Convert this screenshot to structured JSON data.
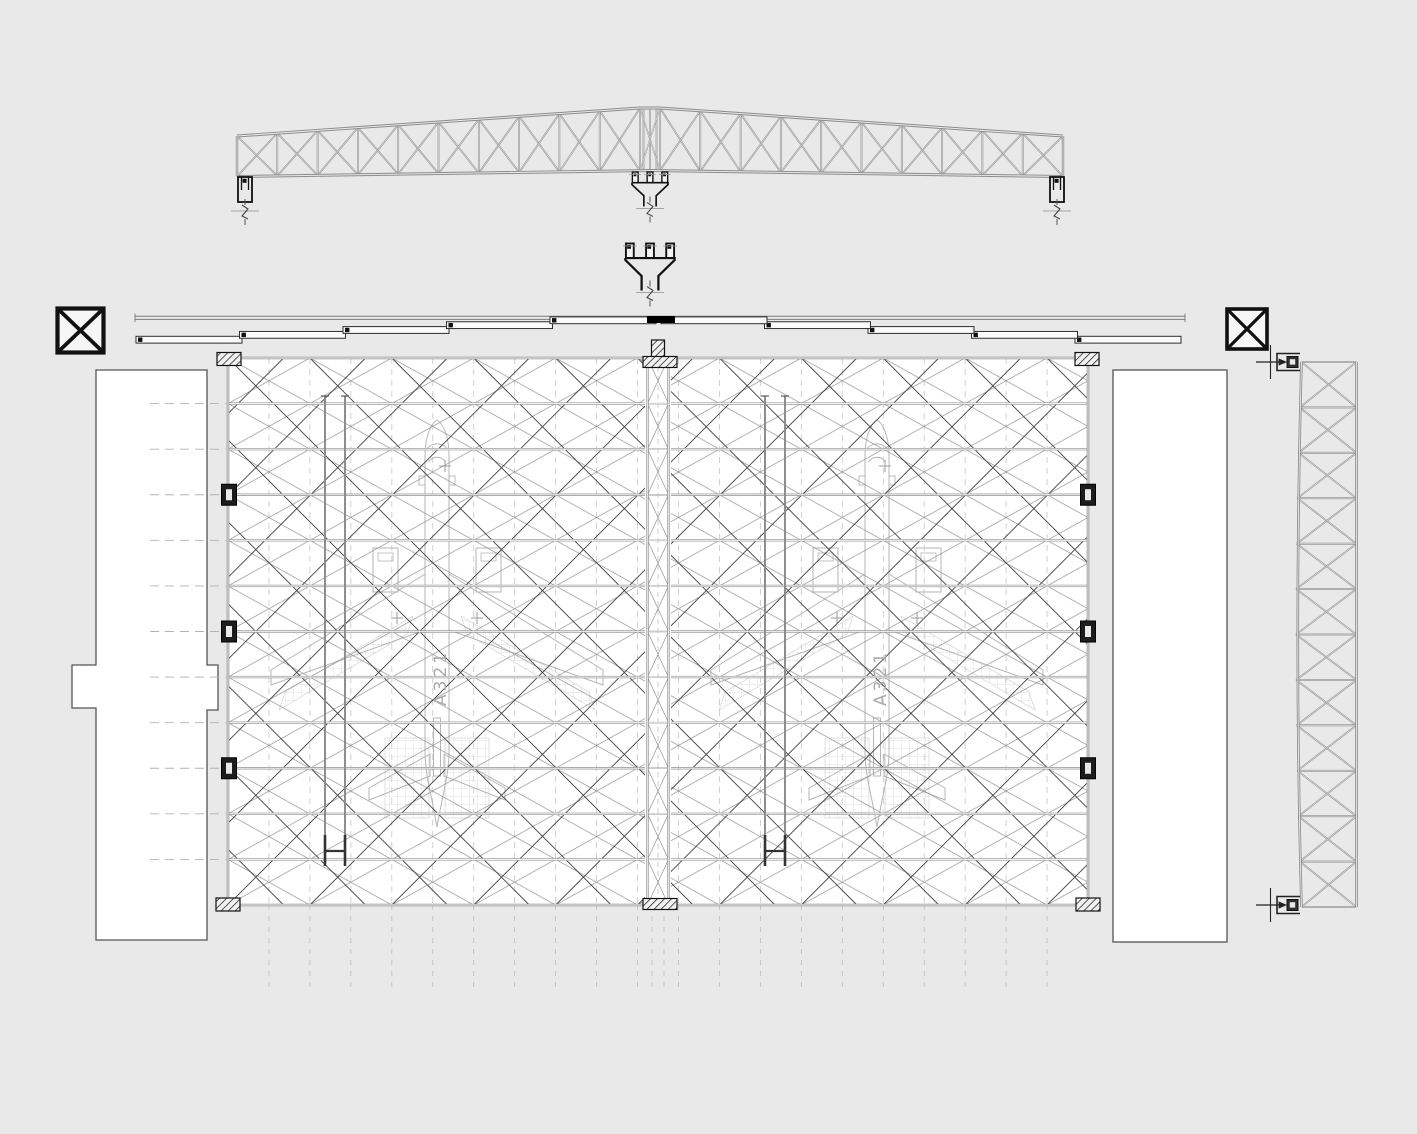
{
  "aircraft": {
    "label": "A321",
    "count": 2
  },
  "palette": {
    "background": "#e9e9e9",
    "ink": "#141414",
    "steel": "#8c8c8c",
    "steel_dark": "#3f3f3f",
    "chord": "#a0a0a0",
    "lattice_minor": "#8f8f8f",
    "faint_dash": "#c0c0c0",
    "aircraft_line": "#b6b6b6",
    "dock_line": "#d6d6d6",
    "white": "#ffffff"
  },
  "plan": {
    "grid_rows": 12,
    "grid_columns": 21,
    "edge_columns_per_side": 3,
    "door_leaves_per_side": 5,
    "crane_rail_pairs": 2
  },
  "roof_girder": {
    "panels_per_half": 10
  },
  "side_truss": {
    "panels": 12
  },
  "markers": {
    "section_marker_count": 2
  }
}
